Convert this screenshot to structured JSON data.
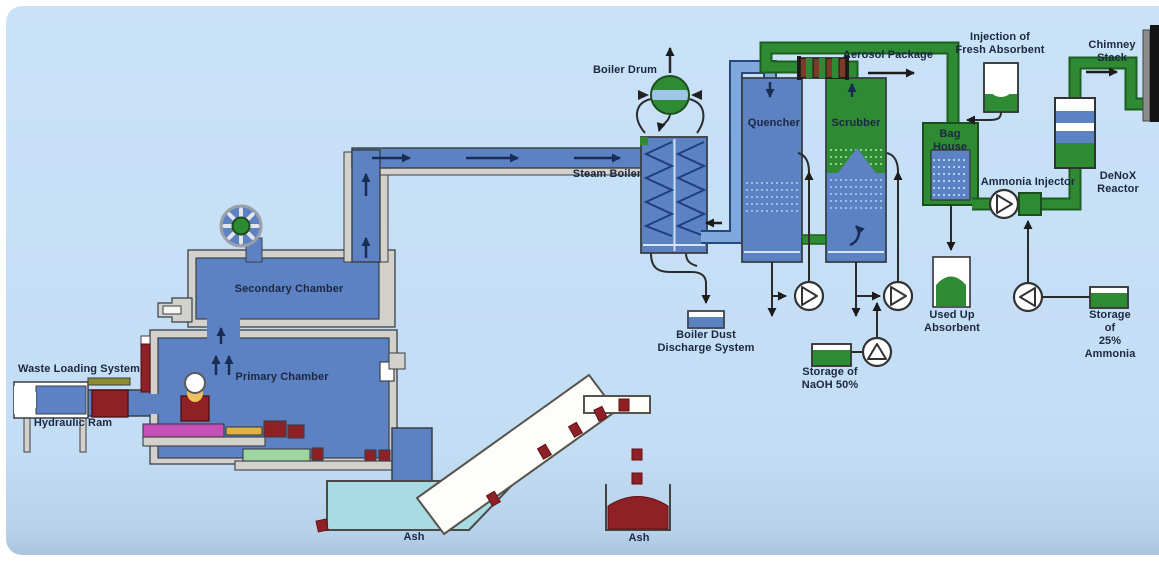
{
  "colors": {
    "background": "#c9e2f8",
    "vessel_blue": "#5d82c4",
    "pipe_blue": "#7fa8dc",
    "pipe_green": "#2e8b33",
    "dark_red": "#8e2026",
    "water_cyan": "#a9dbe4",
    "wall_grey": "#d2d1cc",
    "text_navy": "#1c2740"
  },
  "labels": {
    "waste_loading_system": "Waste Loading System",
    "hydraulic_ram": "Hydraulic Ram",
    "primary_chamber": "Primary Chamber",
    "secondary_chamber": "Secondary Chamber",
    "steam_boiler": "Steam Boiler",
    "boiler_drum": "Boiler Drum",
    "boiler_dust_discharge": "Boiler Dust\nDischarge System",
    "ash_left": "Ash",
    "ash_right": "Ash",
    "quencher": "Quencher",
    "scrubber": "Scrubber",
    "aerosol_package": "Aerosol Package",
    "injection_fresh_absorbent": "Injection of\nFresh Absorbent",
    "bag_house": "Bag\nHouse",
    "used_up_absorbent": "Used Up\nAbsorbent",
    "storage_naoh": "Storage of\nNaOH 50%",
    "ammonia_injector": "Ammonia Injector",
    "denox_reactor": "DeNoX Reactor",
    "chimney_stack": "Chimney Stack",
    "storage_ammonia": "Storage of\n25% Ammonia"
  }
}
